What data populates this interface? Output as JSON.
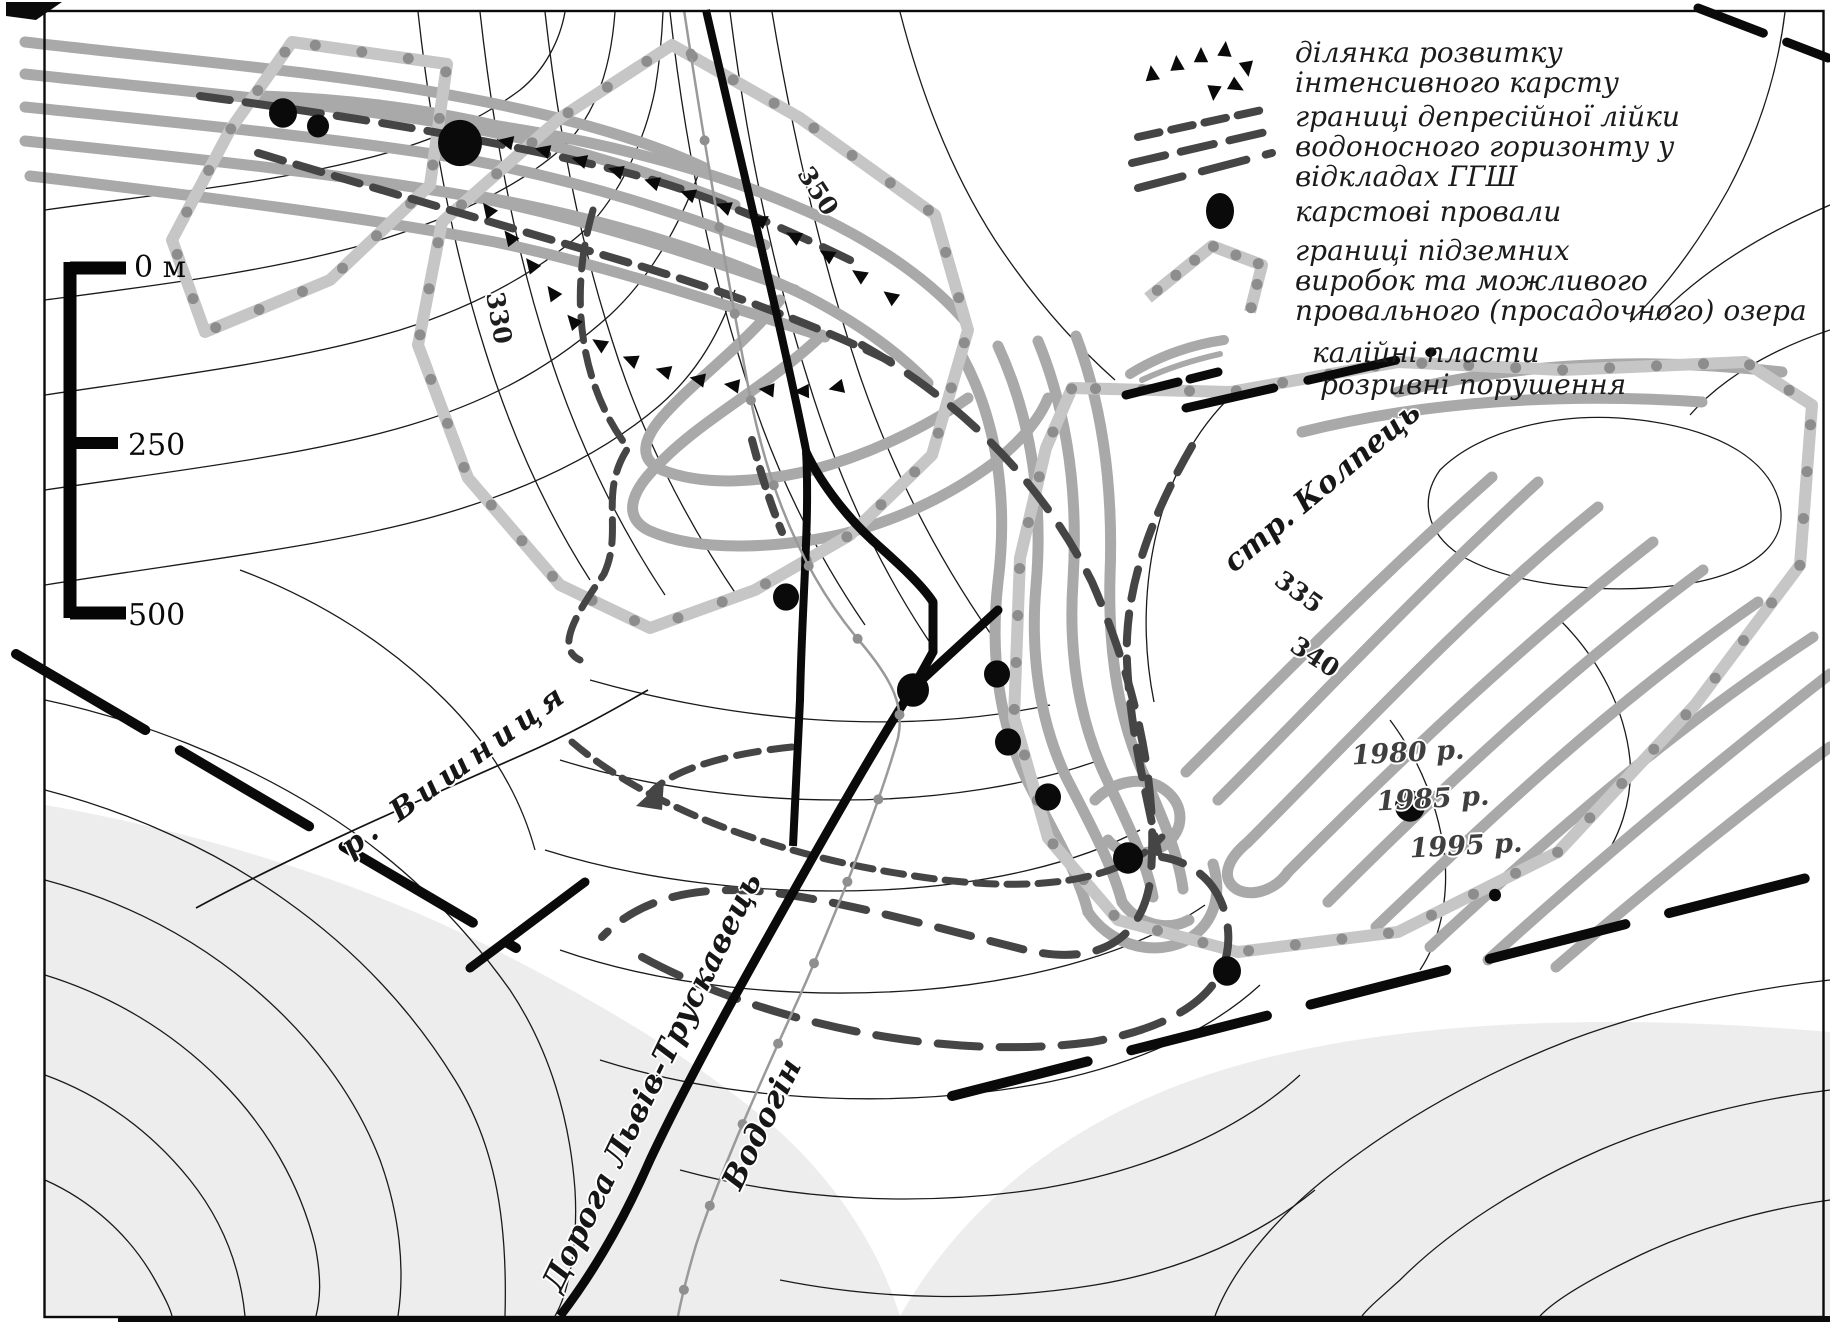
{
  "legend": {
    "items": [
      {
        "symbol": "karst-triangles",
        "lines": [
          "ділянка розвитку",
          "інтенсивного карсту"
        ]
      },
      {
        "symbol": "dashed-lines",
        "lines": [
          "границі депресійної лійки",
          "водоносного горизонту у",
          "відкладах ГГШ"
        ]
      },
      {
        "symbol": "black-dot",
        "lines": [
          "карстові провали"
        ]
      },
      {
        "symbol": "dotted-line",
        "lines": [
          "границі підземних",
          "виробок та можливого",
          "провального (просадочного) озера"
        ]
      },
      {
        "symbol": "gray-band",
        "lines": [
          "калійні пласти"
        ]
      },
      {
        "symbol": "black-dash",
        "lines": [
          "розривні порушення"
        ]
      }
    ]
  },
  "scale_bar": {
    "labels": [
      "0 м",
      "250",
      "500"
    ]
  },
  "map_labels": {
    "river": "р. Вишниця",
    "stream": "стр. Колпець",
    "road": "Дорога Львів-Трускавець",
    "pipeline": "Водогін",
    "years": [
      "1980 р.",
      "1985 р.",
      "1995 р."
    ],
    "contours": [
      "350",
      "330",
      "335",
      "340"
    ]
  },
  "sinkholes": [
    [
      283,
      113,
      14
    ],
    [
      318,
      126,
      11
    ],
    [
      460,
      143,
      22
    ],
    [
      786,
      597,
      13
    ],
    [
      913,
      690,
      16
    ],
    [
      997,
      674,
      13
    ],
    [
      1008,
      742,
      13
    ],
    [
      1048,
      797,
      13
    ],
    [
      1128,
      858,
      15
    ],
    [
      1410,
      806,
      15
    ],
    [
      1227,
      971,
      14
    ],
    [
      1495,
      895,
      6
    ]
  ],
  "colors": {
    "band": "#a9a9a9",
    "dotted_base": "#c6c6c6",
    "dotted_dot": "#8d8d8d",
    "dark_dash": "#454545",
    "black": "#0a0a0a",
    "shade": "#ededed",
    "pipeline": "#9a9a9a"
  }
}
